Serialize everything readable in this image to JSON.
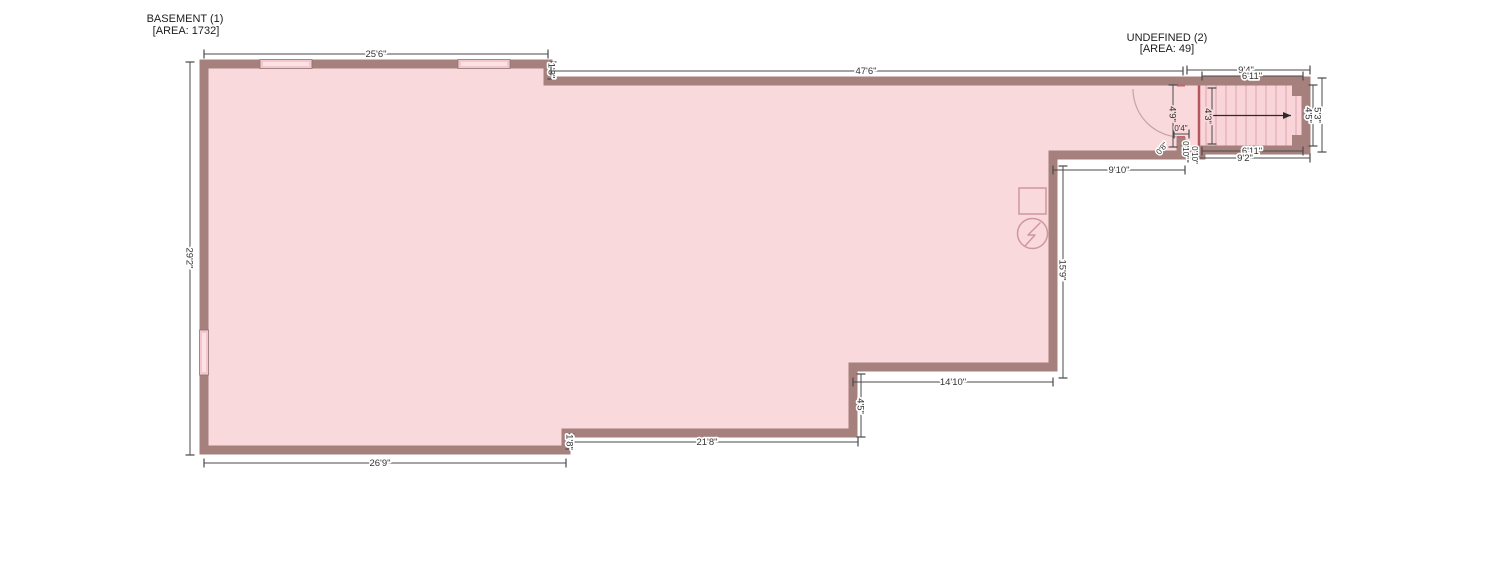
{
  "rooms": [
    {
      "name": "BASEMENT (1)",
      "area_label": "[AREA: 1732]"
    },
    {
      "name": "UNDEFINED (2)",
      "area_label": "[AREA: 49]"
    }
  ],
  "colors": {
    "wall": "#a5807d",
    "floor": "#fad9dc",
    "stair_edge_accent": "#b4565c",
    "dimension_lines": "#4a4a4a",
    "electrical_symbol": "#cf979c",
    "window_fill": "#f3c7cc"
  },
  "icons": {
    "electrical_outlet": "circle-with-lightning-bolt",
    "stair_direction": "right-arrow",
    "door": "quarter-circle-swing-arc"
  },
  "dims": [
    {
      "id": "top-left-width",
      "text": "25'6\""
    },
    {
      "id": "top-step-height",
      "text": "1'3\""
    },
    {
      "id": "top-main-width",
      "text": "47'6\""
    },
    {
      "id": "stair-outer-width",
      "text": "9'4\""
    },
    {
      "id": "stair-inner-width-top",
      "text": "6'11\""
    },
    {
      "id": "left-height",
      "text": "29'2\""
    },
    {
      "id": "landing-height",
      "text": "4'9\""
    },
    {
      "id": "stair-inner-height-left",
      "text": "4'3\""
    },
    {
      "id": "stair-inner-height-right",
      "text": "4'5\""
    },
    {
      "id": "stair-outer-height",
      "text": "5'3\""
    },
    {
      "id": "stair-inner-width-bottom",
      "text": "6'11\""
    },
    {
      "id": "stair-outer-width-bottom",
      "text": "9'2\""
    },
    {
      "id": "landing-wall-thickness",
      "text": "0'4\""
    },
    {
      "id": "jog-diagonal",
      "text": "0'8\""
    },
    {
      "id": "jog-vertical-a",
      "text": "0'10\""
    },
    {
      "id": "jog-vertical-b",
      "text": "0'10\""
    },
    {
      "id": "corridor-width",
      "text": "9'10\""
    },
    {
      "id": "right-wall-height",
      "text": "15'9\""
    },
    {
      "id": "notch-width",
      "text": "14'10\""
    },
    {
      "id": "notch-step-height",
      "text": "4'5\""
    },
    {
      "id": "bottom-middle-width",
      "text": "21'8\""
    },
    {
      "id": "bottom-step-height",
      "text": "1'8\""
    },
    {
      "id": "bottom-left-width",
      "text": "26'9\""
    }
  ]
}
